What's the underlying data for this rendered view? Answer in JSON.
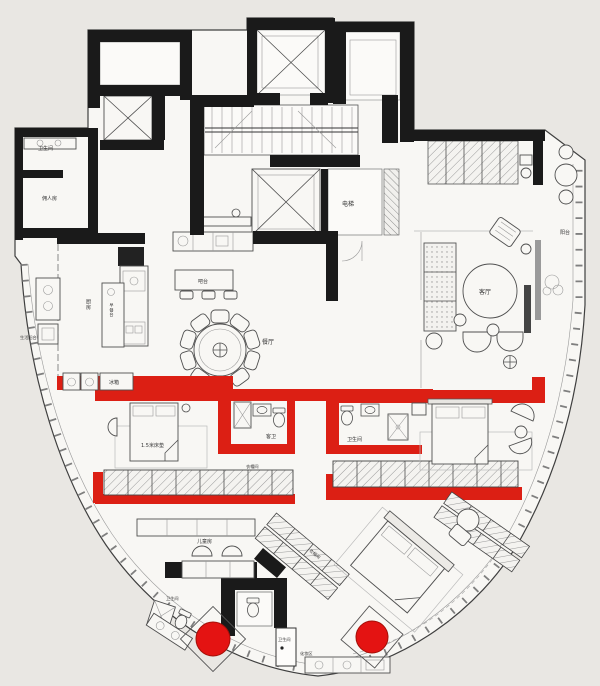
{
  "colors": {
    "background": "#e9e7e3",
    "floor": "#f8f7f4",
    "wall": "#1a1a1a",
    "red_wall": "#dc1f14",
    "tub_red": "#e41312",
    "line_dark": "#4f4f4f",
    "line_light": "#999999",
    "text": "#333333"
  },
  "labels": {
    "bath_top_left": "卫生间",
    "maid_room": "佣人房",
    "elevator": "电梯",
    "kitchen": "厨房",
    "breakfast_bar": "早餐台",
    "service_balcony": "生活阳台",
    "bar_counter": "吧台",
    "dining_room": "餐厅",
    "living_room": "客厅",
    "balcony": "阳台",
    "fridge": "冰箱",
    "bed_size": "1.5米床垫",
    "guest_bath": "客卫",
    "bath_middle": "卫生间",
    "closet_corridor": "衣帽间",
    "kids_room": "儿童房",
    "kids_bath": "卫生间",
    "master_bath": "卫生间",
    "makeup_area": "化妆区",
    "master_closet": "衣帽间"
  }
}
